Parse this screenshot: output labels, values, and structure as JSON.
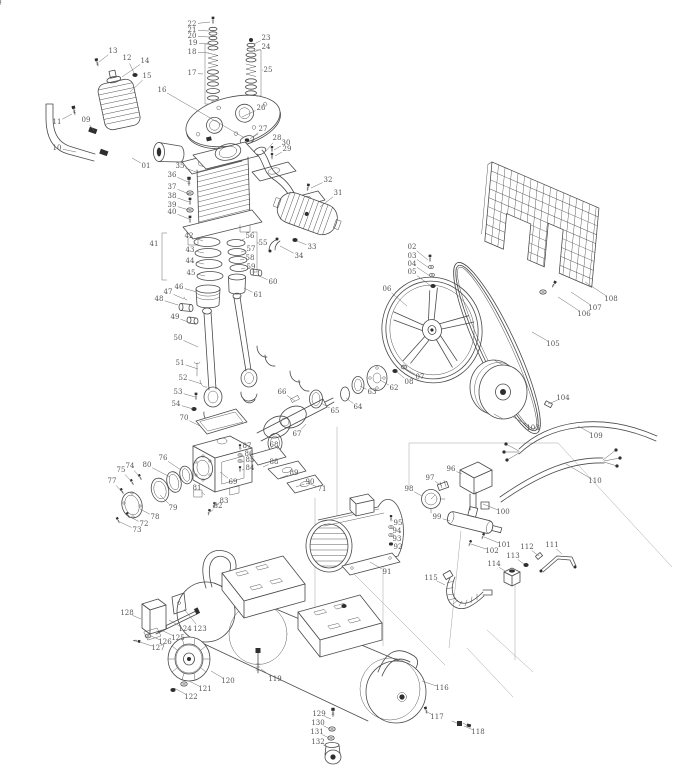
{
  "diagram": {
    "kind": "exploded-parts-diagram",
    "colors": {
      "line": "#4a4a4a",
      "label": "#555555",
      "leader": "#6a6a6a",
      "background": "#ffffff"
    },
    "labels": [
      [
        "01",
        146,
        166,
        132,
        158
      ],
      [
        "02",
        412,
        247,
        428,
        260
      ],
      [
        "03",
        412,
        256,
        429,
        268
      ],
      [
        "04",
        412,
        264,
        430,
        276
      ],
      [
        "05",
        412,
        272,
        431,
        286
      ],
      [
        "06",
        387,
        289,
        407,
        306
      ],
      [
        "07",
        420,
        377,
        406,
        369
      ],
      [
        "08",
        409,
        382,
        397,
        372
      ],
      [
        "09",
        86,
        120,
        94,
        131
      ],
      [
        "10",
        57,
        148,
        76,
        152
      ],
      [
        "11",
        57,
        122,
        72,
        114
      ],
      [
        "12",
        127,
        58,
        134,
        73
      ],
      [
        "13",
        113,
        51,
        99,
        62
      ],
      [
        "14",
        145,
        61,
        122,
        77
      ],
      [
        "15",
        147,
        76,
        130,
        92
      ],
      [
        "16",
        162,
        90,
        243,
        137
      ],
      [
        "17",
        192,
        73,
        203,
        74
      ],
      [
        "18",
        192,
        52,
        209,
        53
      ],
      [
        "19",
        193,
        43,
        209,
        44
      ],
      [
        "20",
        192,
        36,
        209,
        37
      ],
      [
        "21",
        192,
        30,
        209,
        31
      ],
      [
        "22",
        192,
        24,
        210,
        22
      ],
      [
        "23",
        266,
        38,
        254,
        44
      ],
      [
        "24",
        266,
        47,
        254,
        52
      ],
      [
        "25",
        268,
        70,
        263,
        70
      ],
      [
        "26",
        261,
        108,
        242,
        117
      ],
      [
        "27",
        263,
        129,
        250,
        139
      ],
      [
        "28",
        277,
        138,
        266,
        151
      ],
      [
        "29",
        287,
        149,
        275,
        156
      ],
      [
        "30",
        286,
        143,
        274,
        150
      ],
      [
        "31",
        338,
        193,
        320,
        207
      ],
      [
        "32",
        328,
        180,
        311,
        188
      ],
      [
        "33",
        312,
        247,
        297,
        241
      ],
      [
        "34",
        299,
        256,
        280,
        246
      ],
      [
        "35",
        180,
        166,
        196,
        172
      ],
      [
        "36",
        172,
        175,
        188,
        182
      ],
      [
        "37",
        172,
        187,
        189,
        194
      ],
      [
        "38",
        172,
        196,
        189,
        202
      ],
      [
        "39",
        172,
        205,
        189,
        210
      ],
      [
        "40",
        172,
        212,
        189,
        219
      ],
      [
        "41",
        154,
        244,
        160,
        244
      ],
      [
        "42",
        189,
        236,
        203,
        241
      ],
      [
        "43",
        190,
        250,
        204,
        253
      ],
      [
        "44",
        190,
        261,
        204,
        264
      ],
      [
        "45",
        191,
        273,
        205,
        276
      ],
      [
        "46",
        179,
        287,
        197,
        292
      ],
      [
        "47",
        168,
        292,
        184,
        299
      ],
      [
        "48",
        159,
        299,
        178,
        305
      ],
      [
        "49",
        175,
        317,
        188,
        322
      ],
      [
        "50",
        178,
        338,
        198,
        347
      ],
      [
        "51",
        180,
        363,
        198,
        369
      ],
      [
        "52",
        183,
        378,
        202,
        384
      ],
      [
        "53",
        178,
        392,
        195,
        397
      ],
      [
        "54",
        176,
        404,
        193,
        409
      ],
      [
        "55",
        263,
        243,
        259,
        243
      ],
      [
        "56",
        250,
        236,
        240,
        241
      ],
      [
        "57",
        251,
        249,
        241,
        252
      ],
      [
        "58",
        250,
        258,
        240,
        260
      ],
      [
        "59",
        251,
        267,
        241,
        269
      ],
      [
        "60",
        273,
        282,
        259,
        276
      ],
      [
        "61",
        258,
        295,
        244,
        288
      ],
      [
        "62",
        394,
        388,
        380,
        380
      ],
      [
        "63",
        372,
        392,
        360,
        386
      ],
      [
        "64",
        358,
        407,
        346,
        398
      ],
      [
        "65",
        335,
        411,
        321,
        403
      ],
      [
        "66",
        282,
        392,
        295,
        401
      ],
      [
        "67",
        297,
        434,
        306,
        424
      ],
      [
        "68",
        274,
        445,
        277,
        448
      ],
      [
        "69",
        233,
        482,
        220,
        472
      ],
      [
        "70",
        184,
        418,
        200,
        426
      ],
      [
        "71",
        322,
        489,
        308,
        483
      ],
      [
        "72",
        144,
        524,
        130,
        517
      ],
      [
        "73",
        137,
        530,
        120,
        522
      ],
      [
        "74",
        130,
        466,
        140,
        477
      ],
      [
        "75",
        121,
        470,
        132,
        482
      ],
      [
        "76",
        163,
        458,
        181,
        470
      ],
      [
        "77",
        112,
        481,
        122,
        492
      ],
      [
        "78",
        155,
        517,
        140,
        509
      ],
      [
        "79",
        173,
        508,
        160,
        495
      ],
      [
        "80",
        147,
        465,
        170,
        477
      ],
      [
        "81",
        197,
        488,
        205,
        495
      ],
      [
        "82",
        218,
        506,
        210,
        512
      ],
      [
        "83",
        224,
        501,
        215,
        506
      ],
      [
        "84",
        250,
        468,
        242,
        470
      ],
      [
        "85",
        250,
        460,
        242,
        462
      ],
      [
        "86",
        249,
        454,
        241,
        456
      ],
      [
        "87",
        247,
        446,
        241,
        449
      ],
      [
        "88",
        274,
        462,
        263,
        467
      ],
      [
        "89",
        294,
        473,
        280,
        478
      ],
      [
        "90",
        310,
        482,
        296,
        487
      ],
      [
        "91",
        387,
        572,
        370,
        562
      ],
      [
        "92",
        398,
        547,
        392,
        544
      ],
      [
        "93",
        397,
        539,
        391,
        536
      ],
      [
        "94",
        397,
        531,
        391,
        528
      ],
      [
        "95",
        398,
        523,
        392,
        520
      ],
      [
        "96",
        451,
        469,
        462,
        474
      ],
      [
        "97",
        430,
        478,
        442,
        486
      ],
      [
        "98",
        409,
        489,
        422,
        496
      ],
      [
        "99",
        437,
        517,
        450,
        521
      ],
      [
        "100",
        503,
        512,
        483,
        504
      ],
      [
        "101",
        504,
        545,
        484,
        537
      ],
      [
        "102",
        492,
        551,
        471,
        544
      ],
      [
        "103",
        533,
        428,
        513,
        417
      ],
      [
        "104",
        563,
        398,
        548,
        404
      ],
      [
        "105",
        553,
        344,
        532,
        332
      ],
      [
        "106",
        584,
        314,
        558,
        297
      ],
      [
        "107",
        595,
        308,
        571,
        292
      ],
      [
        "108",
        611,
        299,
        585,
        282
      ],
      [
        "109",
        596,
        436,
        578,
        426
      ],
      [
        "110",
        595,
        481,
        566,
        464
      ],
      [
        "111",
        552,
        545,
        562,
        554
      ],
      [
        "112",
        527,
        547,
        539,
        556
      ],
      [
        "113",
        513,
        556,
        524,
        564
      ],
      [
        "114",
        494,
        564,
        505,
        571
      ],
      [
        "115",
        431,
        578,
        445,
        585
      ],
      [
        "116",
        442,
        688,
        422,
        681
      ],
      [
        "117",
        437,
        717,
        427,
        712
      ],
      [
        "118",
        478,
        732,
        464,
        726
      ],
      [
        "119",
        275,
        679,
        261,
        669
      ],
      [
        "120",
        228,
        681,
        211,
        671
      ],
      [
        "121",
        205,
        689,
        189,
        681
      ],
      [
        "122",
        191,
        697,
        174,
        688
      ],
      [
        "123",
        200,
        629,
        184,
        609
      ],
      [
        "124",
        185,
        629,
        169,
        620
      ],
      [
        "125",
        178,
        638,
        161,
        630
      ],
      [
        "126",
        165,
        642,
        151,
        636
      ],
      [
        "127",
        158,
        648,
        140,
        642
      ],
      [
        "128",
        127,
        613,
        141,
        619
      ],
      [
        "129",
        319,
        714,
        331,
        719
      ],
      [
        "130",
        318,
        723,
        330,
        729
      ],
      [
        "131",
        317,
        732,
        329,
        738
      ],
      [
        "132",
        318,
        742,
        327,
        747
      ]
    ],
    "brackets": [
      {
        "x": 205,
        "y1": 44,
        "y2": 104,
        "tick": 5
      },
      {
        "x": 261,
        "y1": 50,
        "y2": 96,
        "tick": -5
      },
      {
        "x": 162,
        "y1": 233,
        "y2": 280,
        "tick": 5
      },
      {
        "x": 257,
        "y1": 232,
        "y2": 272,
        "tick": -5
      }
    ]
  }
}
